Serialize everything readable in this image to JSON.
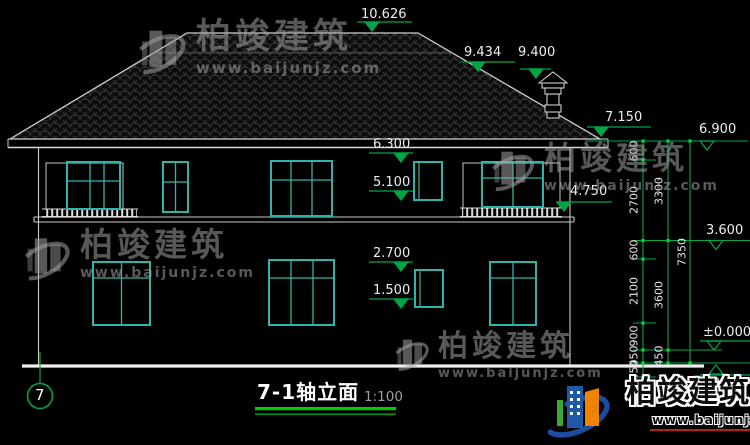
{
  "titleblock": {
    "name": "7-1轴立面",
    "scale": "1:100"
  },
  "axis": {
    "label": "7"
  },
  "levels": {
    "ridge": "10.626",
    "roof_break": "9.434",
    "chimney_top": "9.400",
    "eave_right": "7.150",
    "roof_base": "6.900",
    "f2_window_head": "6.300",
    "f2_window_sill": "5.100",
    "balcony_rail": "4.750",
    "floor2": "3.600",
    "f1_window_head": "2.700",
    "f1_window_sill": "1.500",
    "ground": "±0.000",
    "outdoor": "-0.450"
  },
  "dims": {
    "inner": [
      "600",
      "2700",
      "600",
      "2100",
      "900",
      "450",
      "450"
    ],
    "middle": [
      "3300",
      "3600",
      "450"
    ],
    "outer": [
      "7350"
    ]
  },
  "watermark": {
    "name": "柏竣建筑",
    "url": "www.baijunjz.com"
  },
  "brand": {
    "name": "柏竣建筑",
    "url": "www.baijunjz.com"
  },
  "colors": {
    "dimension_green": "#00a646",
    "window_teal": "#2cb5aa",
    "outline_gray": "#c9c9c9"
  }
}
